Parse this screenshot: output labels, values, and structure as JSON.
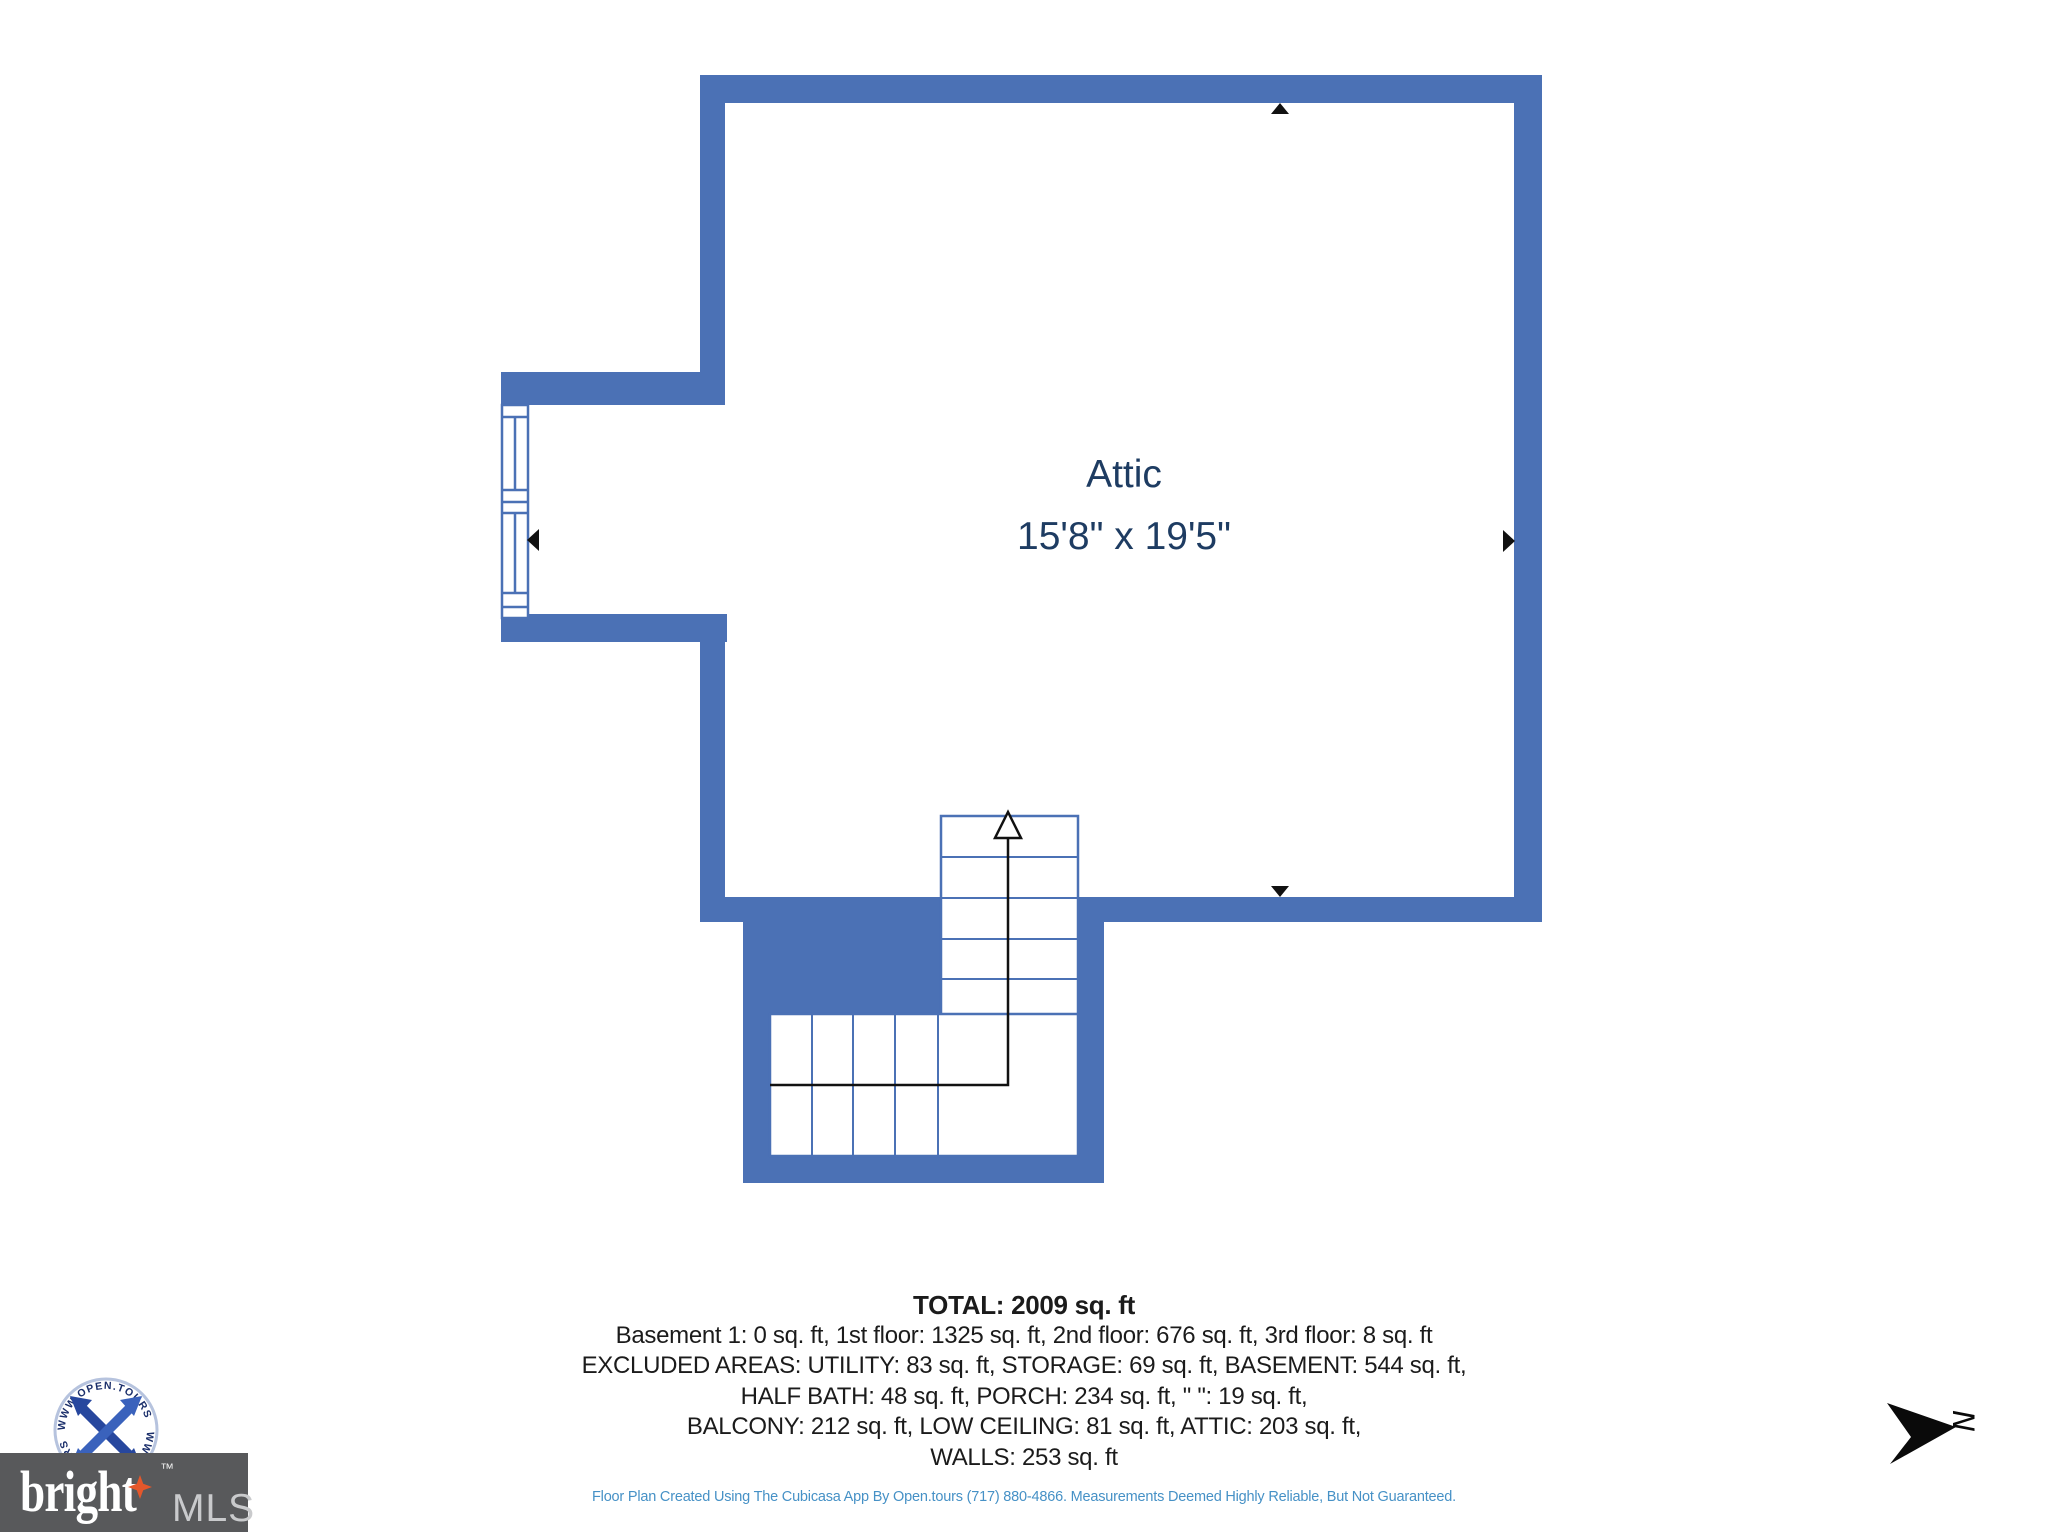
{
  "floor_plan": {
    "room_label": "Attic",
    "room_dimensions": "15'8\" x 19'5\"",
    "wall_color": "#4b71b5",
    "label_color": "#1e3c62",
    "stair_direction": "up"
  },
  "summary": {
    "total_line": "TOTAL: 2009 sq. ft",
    "lines": [
      "Basement 1: 0 sq. ft, 1st floor: 1325 sq. ft, 2nd floor: 676 sq. ft, 3rd floor: 8 sq. ft",
      "EXCLUDED AREAS: UTILITY: 83 sq. ft, STORAGE: 69 sq. ft, BASEMENT: 544 sq. ft,",
      "HALF BATH: 48 sq. ft, PORCH: 234 sq. ft, \" \": 19 sq. ft,",
      "BALCONY: 212 sq. ft, LOW CEILING: 81 sq. ft, ATTIC: 203 sq. ft,",
      "WALLS: 253 sq. ft"
    ]
  },
  "disclaimer": {
    "text": "Floor Plan Created Using The Cubicasa App By Open.tours (717) 880-4866. Measurements Deemed Highly Reliable, But Not Guaranteed.",
    "color": "#4691c6"
  },
  "logos": {
    "open_tours_ring_text": "WWW.OPEN.TOURS",
    "bright": "bright",
    "trademark": "™",
    "mls": "MLS"
  },
  "compass": {
    "north_label": "N"
  }
}
